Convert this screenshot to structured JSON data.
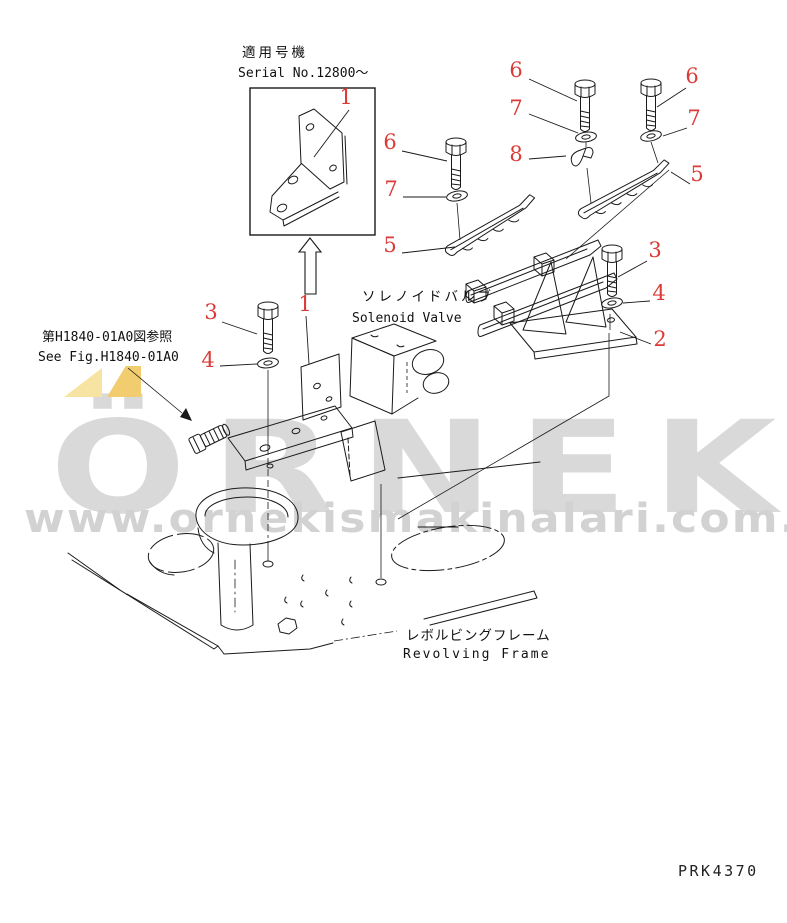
{
  "meta": {
    "background": "#ffffff",
    "line_color": "#1a1a1a",
    "label_color": "#da3b37",
    "drawing_number": "PRK4370"
  },
  "watermark": {
    "brand": "ÖRNEK",
    "url": "www.ornekismakinalari.com.tr",
    "text_color": "#d9d9d9",
    "url_color": "#d2d2d2",
    "accent_light": "#f8e4a2",
    "accent_dark": "#f1cd6f"
  },
  "annotations": {
    "serial_note": {
      "jp": "適用号機",
      "en": "Serial No.12800〜"
    },
    "solenoid_valve": {
      "jp": "ソレノイドバルブ",
      "en": "Solenoid Valve"
    },
    "see_fig": {
      "jp": "第H1840-01A0図参照",
      "en": "See Fig.H1840-01A0"
    },
    "revolving_frame": {
      "jp": "レボルビングフレーム",
      "en": "Revolving Frame"
    }
  },
  "callouts": [
    {
      "label": "1",
      "x": 346,
      "y": 104,
      "leader": [
        349,
        110,
        314,
        157
      ]
    },
    {
      "label": "6",
      "x": 516,
      "y": 77,
      "leader": [
        529,
        79,
        577,
        101
      ]
    },
    {
      "label": "7",
      "x": 516,
      "y": 115,
      "leader": [
        529,
        114,
        578,
        133
      ]
    },
    {
      "label": "8",
      "x": 516,
      "y": 161,
      "leader": [
        529,
        159,
        566,
        156
      ]
    },
    {
      "label": "6",
      "x": 692,
      "y": 83,
      "leader": [
        686,
        88,
        657,
        107
      ]
    },
    {
      "label": "7",
      "x": 694,
      "y": 125,
      "leader": [
        687,
        128,
        663,
        136
      ]
    },
    {
      "label": "5",
      "x": 697,
      "y": 181,
      "leader": [
        690,
        184,
        671,
        172
      ]
    },
    {
      "label": "6",
      "x": 390,
      "y": 149,
      "leader": [
        402,
        151,
        447,
        161
      ]
    },
    {
      "label": "7",
      "x": 391,
      "y": 196,
      "leader": [
        403,
        197,
        446,
        197
      ]
    },
    {
      "label": "5",
      "x": 390,
      "y": 252,
      "leader": [
        402,
        253,
        455,
        247
      ]
    },
    {
      "label": "1",
      "x": 305,
      "y": 311,
      "leader": [
        306,
        316,
        309,
        364
      ]
    },
    {
      "label": "3",
      "x": 211,
      "y": 319,
      "leader": [
        222,
        322,
        257,
        334
      ]
    },
    {
      "label": "4",
      "x": 208,
      "y": 367,
      "leader": [
        220,
        366,
        257,
        364
      ]
    },
    {
      "label": "3",
      "x": 655,
      "y": 257,
      "leader": [
        647,
        261,
        618,
        277
      ]
    },
    {
      "label": "4",
      "x": 659,
      "y": 300,
      "leader": [
        650,
        301,
        623,
        303
      ]
    },
    {
      "label": "2",
      "x": 660,
      "y": 346,
      "leader": [
        651,
        344,
        620,
        332
      ]
    }
  ]
}
